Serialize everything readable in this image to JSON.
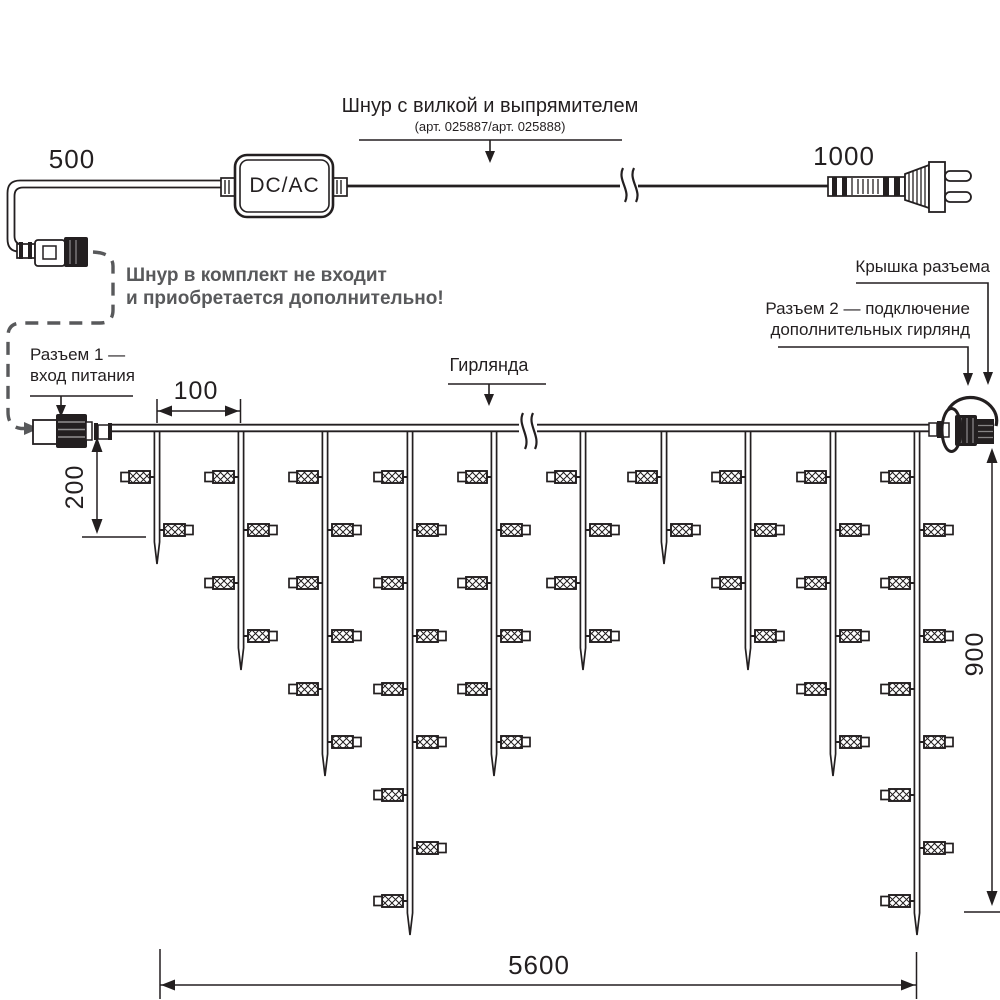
{
  "labels": {
    "cord_title": "Шнур с вилкой и выпрямителем",
    "cord_subtitle": "(арт. 025887/арт. 025888)",
    "note_line1": "Шнур в комплект не входит",
    "note_line2": "и приобретается дополнительно!",
    "connector1_line1": "Разъем 1 —",
    "connector1_line2": "вход питания",
    "garland": "Гирлянда",
    "cap": "Крышка разъема",
    "connector2_line1": "Разъем 2 — подключение",
    "connector2_line2": "дополнительных гирлянд",
    "converter": "DC/AC"
  },
  "dimensions": {
    "cord_left": "500",
    "cord_right": "1000",
    "lamp_spacing": "100",
    "short_drop": "200",
    "long_drop": "900",
    "garland_length": "5600"
  },
  "colors": {
    "line": "#231f20",
    "note": "#58595b",
    "background": "#ffffff"
  },
  "garland": {
    "wire_y": 431,
    "lamp_row_start": 477,
    "lamp_row_step": 53,
    "tip_extra": 30,
    "strands": [
      {
        "x": 157,
        "lamps": 2
      },
      {
        "x": 241,
        "lamps": 4
      },
      {
        "x": 325,
        "lamps": 6
      },
      {
        "x": 410,
        "lamps": 9
      },
      {
        "x": 494,
        "lamps": 6
      },
      {
        "x": 583,
        "lamps": 4
      },
      {
        "x": 664,
        "lamps": 2
      },
      {
        "x": 748,
        "lamps": 4
      },
      {
        "x": 833,
        "lamps": 6
      },
      {
        "x": 917,
        "lamps": 9
      }
    ]
  }
}
